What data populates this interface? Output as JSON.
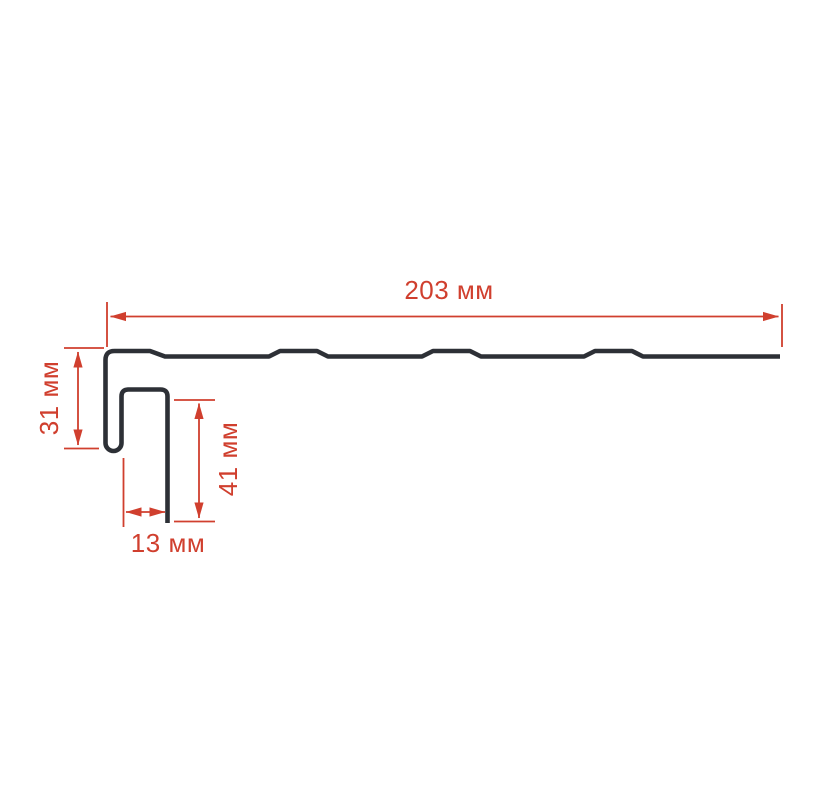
{
  "drawing": {
    "kind": "profile-cross-section-technical-drawing",
    "units": "мм",
    "dimensions": {
      "length": {
        "label": "203 мм",
        "value_mm": 203,
        "orientation": "horizontal",
        "measures": "total panel length"
      },
      "height": {
        "label": "31 мм",
        "value_mm": 31,
        "orientation": "vertical",
        "measures": "left hook height"
      },
      "leg": {
        "label": "41 мм",
        "value_mm": 41,
        "orientation": "vertical",
        "measures": "inner leg height"
      },
      "width": {
        "label": "13 мм",
        "value_mm": 13,
        "orientation": "horizontal",
        "measures": "hook channel width"
      }
    },
    "colors": {
      "dimension_red": "#d03f2e",
      "profile_dark": "#2d3036",
      "background": "#ffffff"
    }
  }
}
